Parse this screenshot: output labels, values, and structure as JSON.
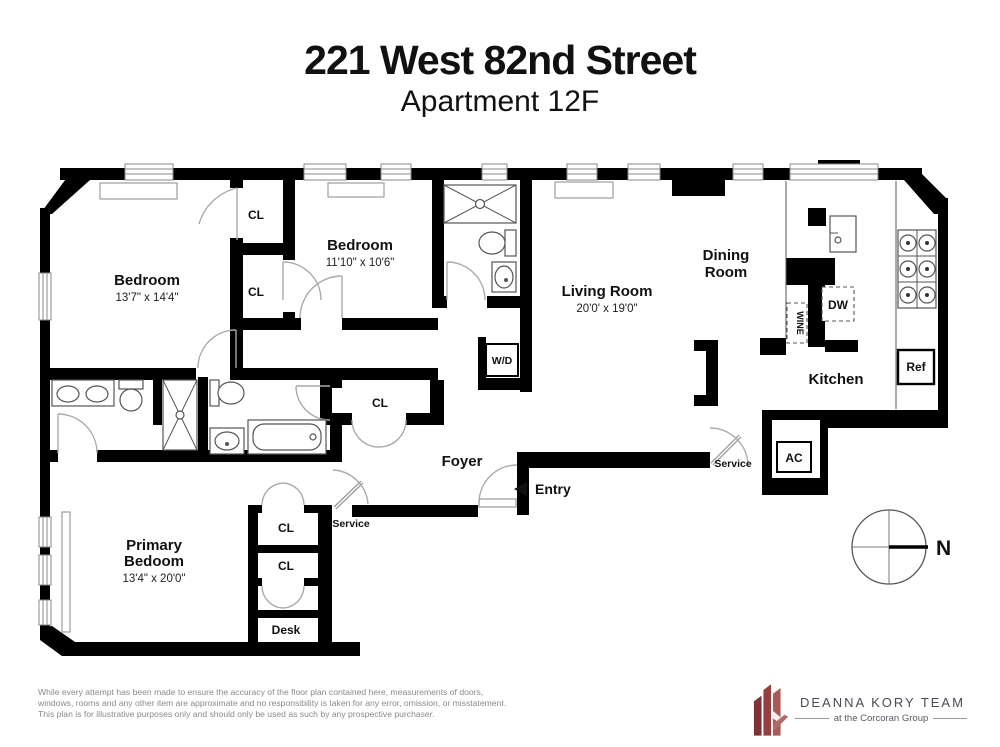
{
  "title": {
    "address": "221 West 82nd Street",
    "unit": "Apartment 12F"
  },
  "plan": {
    "bedroom1": {
      "name": "Bedroom",
      "dims": "13'7\" x 14'4\""
    },
    "bedroom2": {
      "name": "Bedroom",
      "dims": "11'10\" x 10'6\""
    },
    "living": {
      "name": "Living Room",
      "dims": "20'0' x 19'0\""
    },
    "dining": {
      "name_line1": "Dining",
      "name_line2": "Room"
    },
    "kitchen": {
      "name": "Kitchen"
    },
    "foyer": {
      "name": "Foyer"
    },
    "primary": {
      "name_line1": "Primary",
      "name_line2": "Bedoom",
      "dims": "13'4\" x 20'0\""
    },
    "labels": {
      "closet": "CL",
      "washer_dryer": "W/D",
      "dishwasher": "DW",
      "wine": "WINE",
      "refrigerator": "Ref",
      "ac": "AC",
      "service": "Service",
      "entry": "Entry",
      "entry_arrow": "◄",
      "desk": "Desk",
      "north": "N"
    }
  },
  "footer": {
    "disclaimer_line1": "While every attempt has been made to ensure the accuracy of the floor plan contained here, measurements of doors,",
    "disclaimer_line2": "windows, rooms and any other item are approximate and no responsibility is taken for any error, omission, or misstatement.",
    "disclaimer_line3": "This plan is for illustrative purposes only and should only be used as such by any prospective purchaser."
  },
  "logo": {
    "team": "DEANNA KORY TEAM",
    "tagline": "at the Corcoran Group"
  },
  "colors": {
    "wall": "#000000",
    "door_arc": "#aaaaaa",
    "fixture_stroke": "#555555",
    "logo_red": "#8e3d3e",
    "logo_text": "#4a4a55",
    "disclaimer_text": "#8a8a8a"
  }
}
